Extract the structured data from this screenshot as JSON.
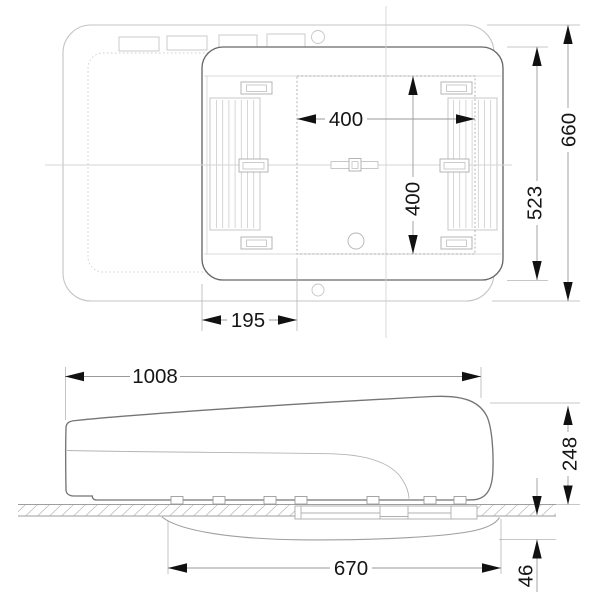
{
  "drawing": {
    "title": "rooftop-air-conditioner-dimension-drawing",
    "views": {
      "top": "top-view",
      "side": "side-view"
    }
  },
  "colors": {
    "ink": "#161616",
    "unit_line": "#6b6b6b",
    "light_line": "#c6c6c6",
    "dim_line": "#9a9a9a",
    "background": "#ffffff"
  },
  "dims": {
    "opening_width": "400",
    "opening_length": "400",
    "opening_offset": "195",
    "unit_body_width": "523",
    "cover_width": "660",
    "overall_length": "1008",
    "height_above_roof": "248",
    "interior_unit_length": "670",
    "interior_unit_depth": "46"
  }
}
